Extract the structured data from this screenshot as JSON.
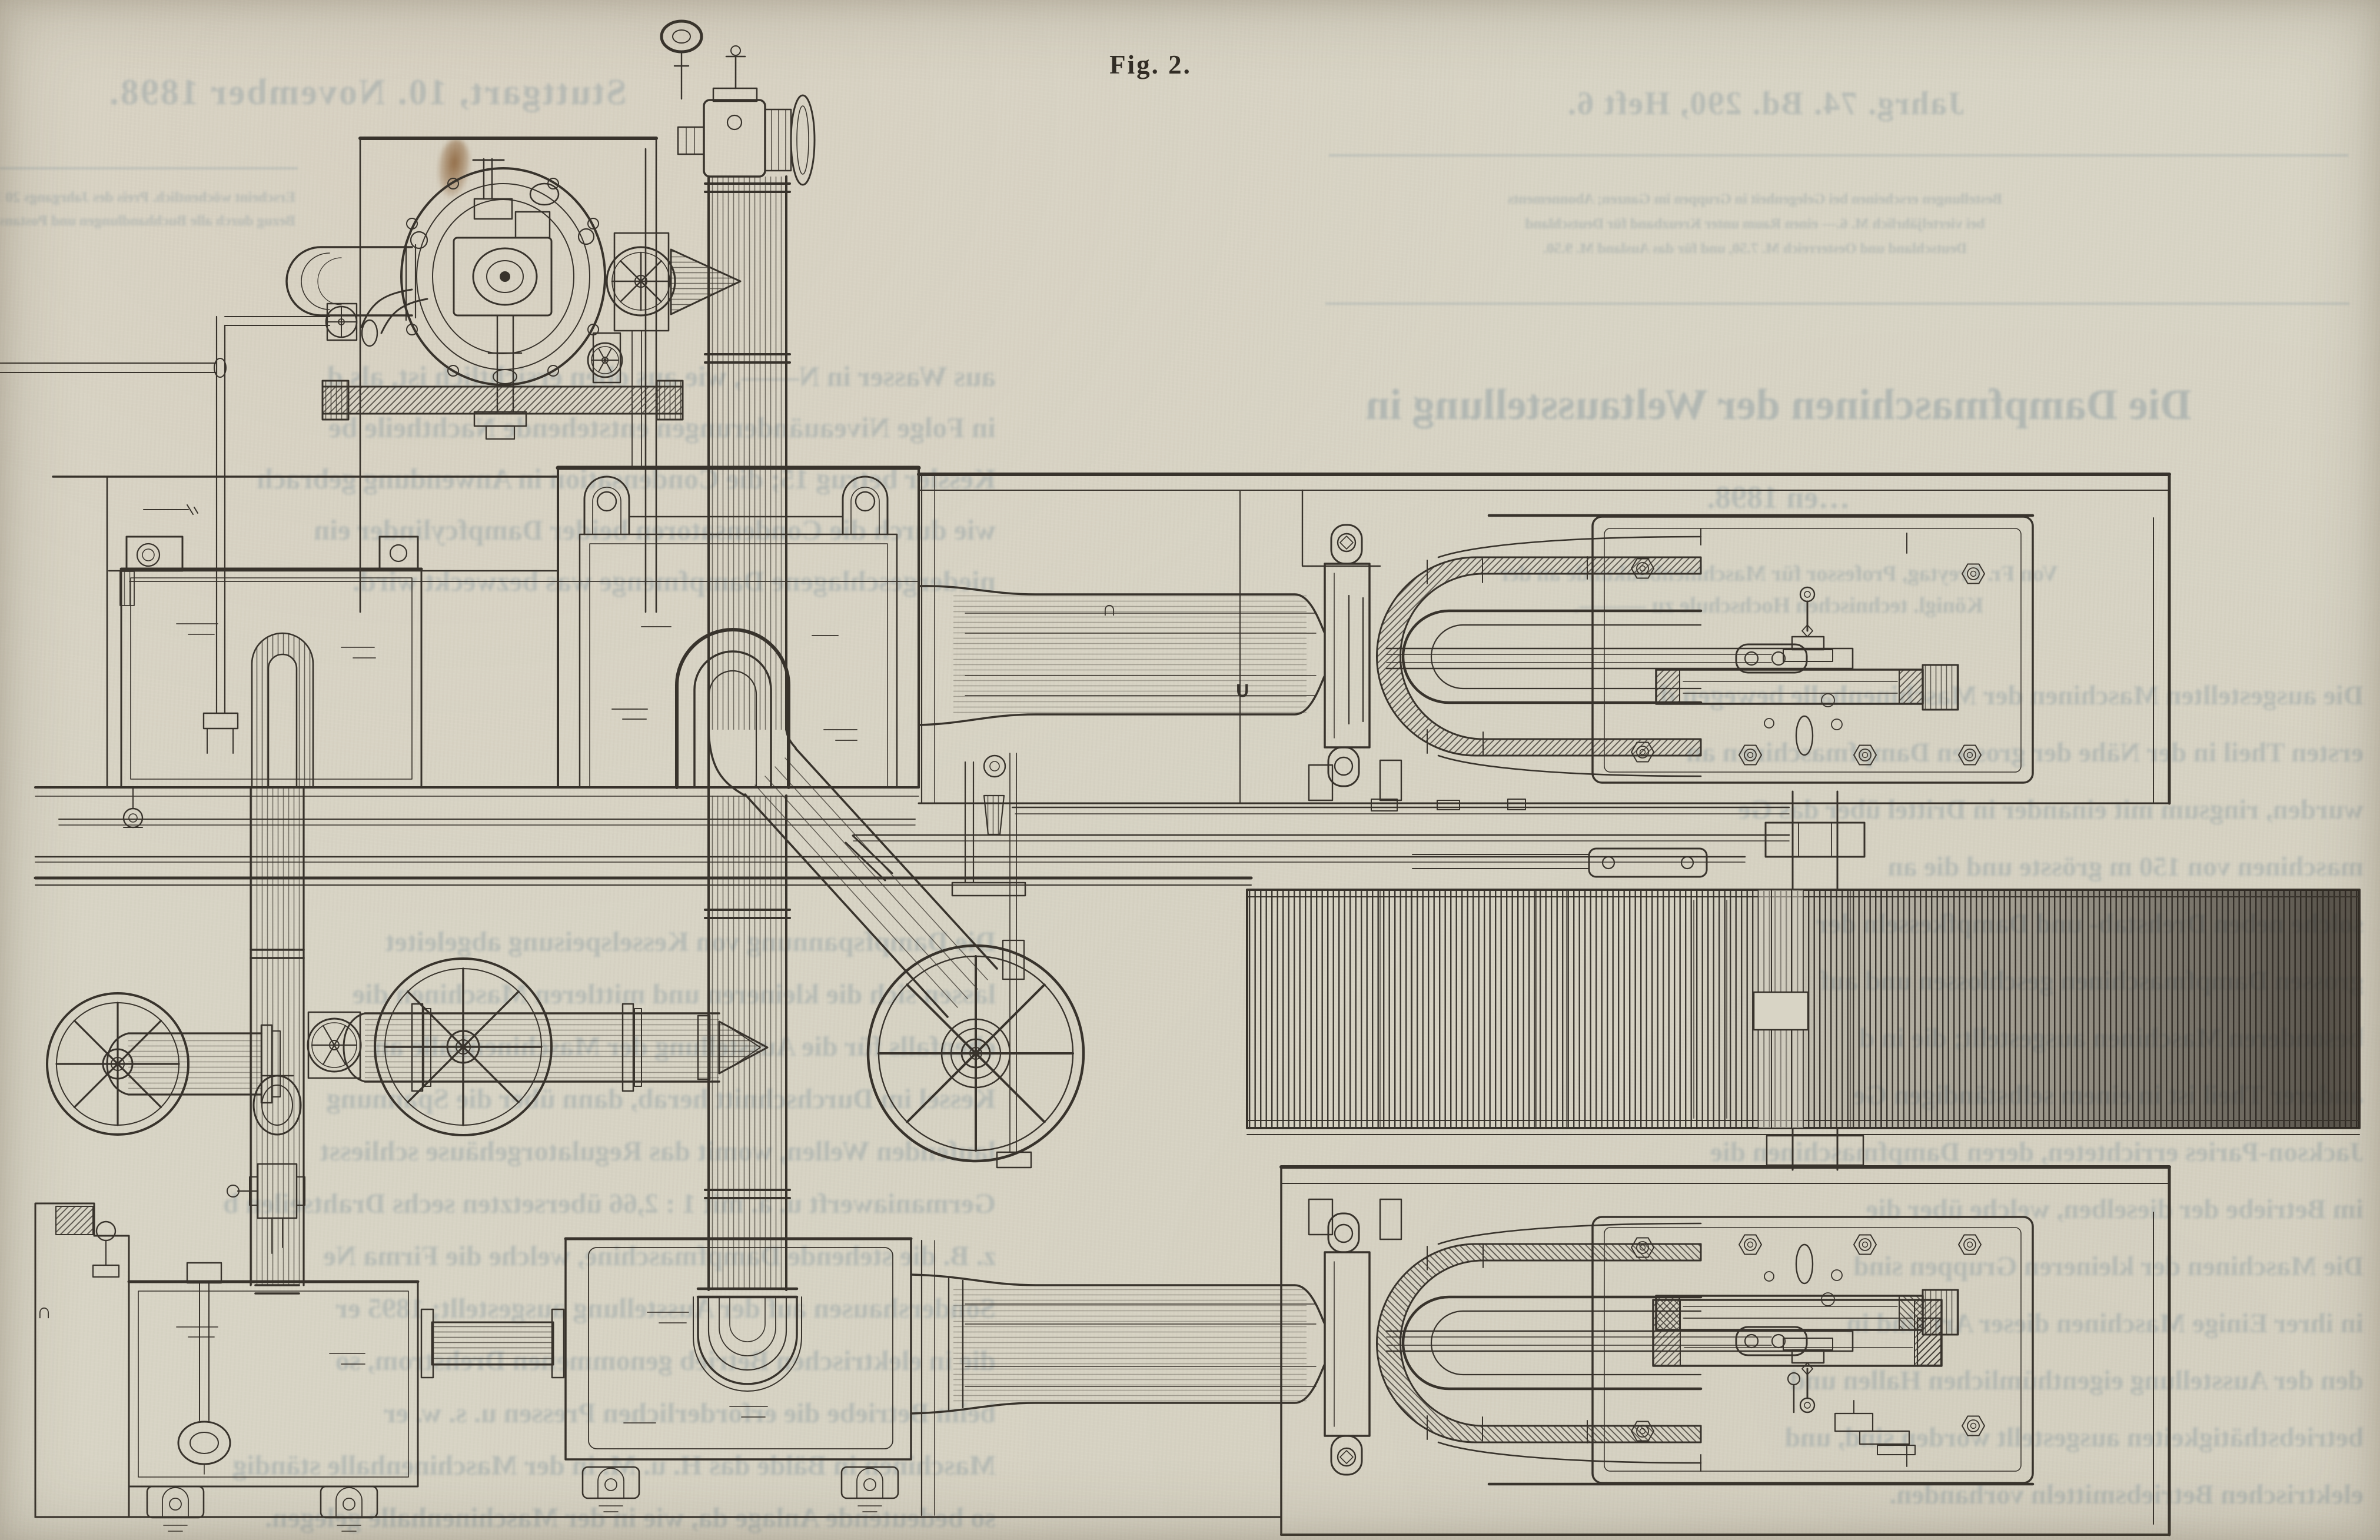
{
  "page": {
    "kind": "scanned journal page with engraving",
    "paper_color": "#d8d4c5",
    "ink_color": "#38332c",
    "ghost_text_color": "#87989f"
  },
  "figure": {
    "caption": "Fig. 2.",
    "ref_marks": {
      "cap_on_pipe": "∩",
      "cup_near_cylinder": "∪",
      "cap_lower_left": "∩"
    }
  },
  "bleed_through": {
    "note": "mirrored text showing through from reverse side of the page",
    "left_column": {
      "masthead": "Stuttgart, 10. November 1898.",
      "note_lines": [
        "Erscheint wöchentlich. Preis des Jahrgangs 20 M.",
        "Bezug durch alle Buchhandlungen und Postanstalten."
      ],
      "body_upper": [
        "aus Wasser in N——, wie aus oben ersichtlich ist, als d",
        "in Folge Niveauänderungen entstehende Nachtheile be",
        "Kessler betrug 15; die Condensation in Anwendung gebrach",
        "wie durch die Condensatoren beider Dampfcylinder ein",
        "niedergeschlagene Dampfmenge was bezweckt wird."
      ],
      "body_lower": [
        "Die Dampfspannung von Kesselspeisung abgeleitet",
        "lassen sich die kleineren und mittleren Maschinen die",
        "ebenfalls für die Ausstellung der Maschinenhalle an",
        "Kessel im Durchschnitt herab, dann über die Spannung",
        "laufenden Wellen, womit das Regulatorgehäuse schliesst",
        "Germaniawerft u. a. mit 1 : 2,66 übersetzten sechs Drahtseilen b",
        "z. B. die stehende Dampfmaschine, welche die Firma Ne",
        "Sondershausen auf der Ausstellung ausgestellt; 1895 er",
        "die in elektrischen Betrieb genommenen Drehstrom, so",
        "beim Betriebe die erforderlichen Pressen u. s. w. er",
        "Maschinen in Bälde das H. u. M. in der Maschinenhalle ständig",
        "so bedeutende Anlage da, wie in der Maschinenhalle gelegen."
      ]
    },
    "right_column": {
      "masthead": "Jahrg. 74. Bd. 290, Heft 6.",
      "note_lines": [
        "Bestellungen erscheinen bei Gelegenheit in Gruppen im Ganzen; Abonnements",
        "bei vierteljährlich M. 6.— einen Raum unter Kreuzband für Deutschland",
        "Deutschland und Oesterreich M. 7.50, und für das Ausland M. 9.50."
      ],
      "heading1": "Die Dampfmaschinen der Weltausstellung in",
      "heading2": "…en 1898.",
      "byline_lines": [
        "Von Fr. Freytag, Professor für Maschinenbaukunde an der",
        "Königl. technischen Hochschule zu ———."
      ],
      "body": [
        "Die ausgestellten Maschinen der Maschinenhalle bewegen d",
        "ersten Theil in der Nähe der grossen Dampfmaschinen an",
        "wurden, ringsum mit einander in Drittel über das Ge",
        "maschinen von 150 m grösste und die an",
        "solche neben Drehstab- und Dampfkesseln der",
        "grossen Dampfmaschinen geschlossen und auf",
        "besonderen Maschinen ausgestellt; die in d",
        "anderer Theil ist in einem selbständigen Ge",
        "Jackson-Paries errichteten, deren Dampfmaschinen die",
        "im Betriebe der dieselben, welche über die",
        "Die Maschinen der kleineren Gruppen sind",
        "in ihrer Einige Maschinen dieser Art sind in",
        "den der Ausstellung eigenthümlichen Hallen und",
        "betriebsthätigkeiten ausgestellt worden sind, und",
        "elektrischen Betriebsmitteln vorhanden."
      ]
    }
  }
}
